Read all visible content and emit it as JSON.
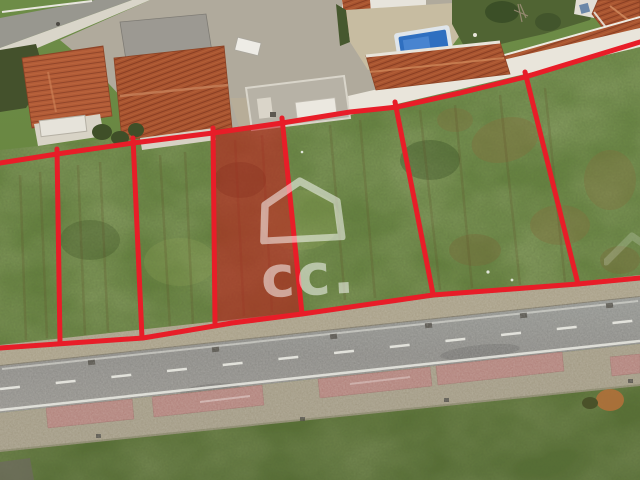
{
  "description": "Aerial drone photograph of six grass building plots outlined in red beside a road; one plot is highlighted with a translucent red fill; white real-estate house-logo watermark in the centre.",
  "watermark": {
    "text": "cc.",
    "icon": "house-outline-icon",
    "color": "#ffffff",
    "opacity": 0.52
  },
  "overlay": {
    "line_color": "#e81d28",
    "line_width": 5,
    "highlight_fill": "rgba(198,22,26,0.55)",
    "top_boundary": [
      [
        0,
        163
      ],
      [
        57,
        154
      ],
      [
        133,
        143
      ],
      [
        213,
        133
      ],
      [
        282,
        123
      ],
      [
        350,
        112
      ],
      [
        397,
        107
      ],
      [
        460,
        93
      ],
      [
        525,
        77
      ],
      [
        640,
        42
      ]
    ],
    "bottom_boundary": [
      [
        0,
        348
      ],
      [
        143,
        338
      ],
      [
        232,
        323
      ],
      [
        302,
        314
      ],
      [
        433,
        295
      ],
      [
        578,
        284
      ],
      [
        640,
        278
      ]
    ],
    "dividers": [
      [
        [
          57,
          149
        ],
        [
          60,
          343
        ]
      ],
      [
        [
          133,
          138
        ],
        [
          142,
          338
        ]
      ],
      [
        [
          213,
          128
        ],
        [
          215,
          323
        ]
      ],
      [
        [
          282,
          118
        ],
        [
          302,
          314
        ]
      ],
      [
        [
          395,
          102
        ],
        [
          433,
          294
        ]
      ],
      [
        [
          525,
          72
        ],
        [
          578,
          284
        ]
      ]
    ],
    "highlighted_plot": [
      [
        213,
        133
      ],
      [
        282,
        123
      ],
      [
        302,
        313
      ],
      [
        216,
        322
      ]
    ]
  },
  "palette": {
    "grass": "#67853f",
    "road_asphalt": "#8e8d89",
    "sidewalk": "#a89f87",
    "roof_tile": "#b25c37",
    "white_wall": "#e9e5db",
    "pool_water": "#2f6fc0",
    "pink_paver": "#b2837c",
    "garden_dark": "#506433"
  }
}
